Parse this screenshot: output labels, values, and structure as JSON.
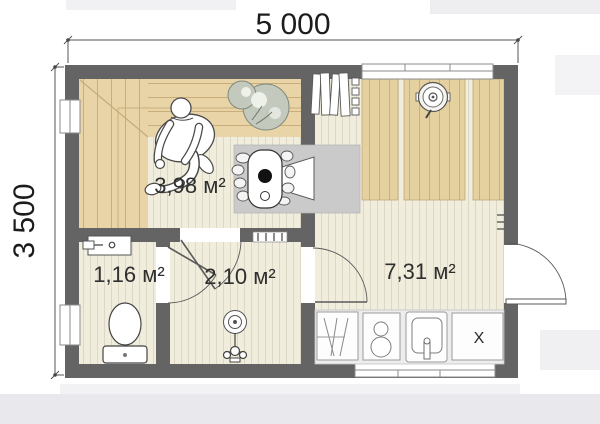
{
  "plan": {
    "dimensions": {
      "width_label": "5 000",
      "height_label": "3 500"
    },
    "rooms": [
      {
        "id": "sauna",
        "area_label": "3,98 м²"
      },
      {
        "id": "wc",
        "area_label": "1,16 м²"
      },
      {
        "id": "shower",
        "area_label": "2,10 м²"
      },
      {
        "id": "lounge",
        "area_label": "7,31 м²"
      }
    ],
    "kitchen": {
      "cabinet_label": "X"
    },
    "colors": {
      "wall": "#646464",
      "bench_wood": "#e8d4a7",
      "floor": "#f0eddc",
      "plank_wood": "#e5d0a0",
      "stove_pad": "#cacaca",
      "counter": "#ededed"
    }
  }
}
